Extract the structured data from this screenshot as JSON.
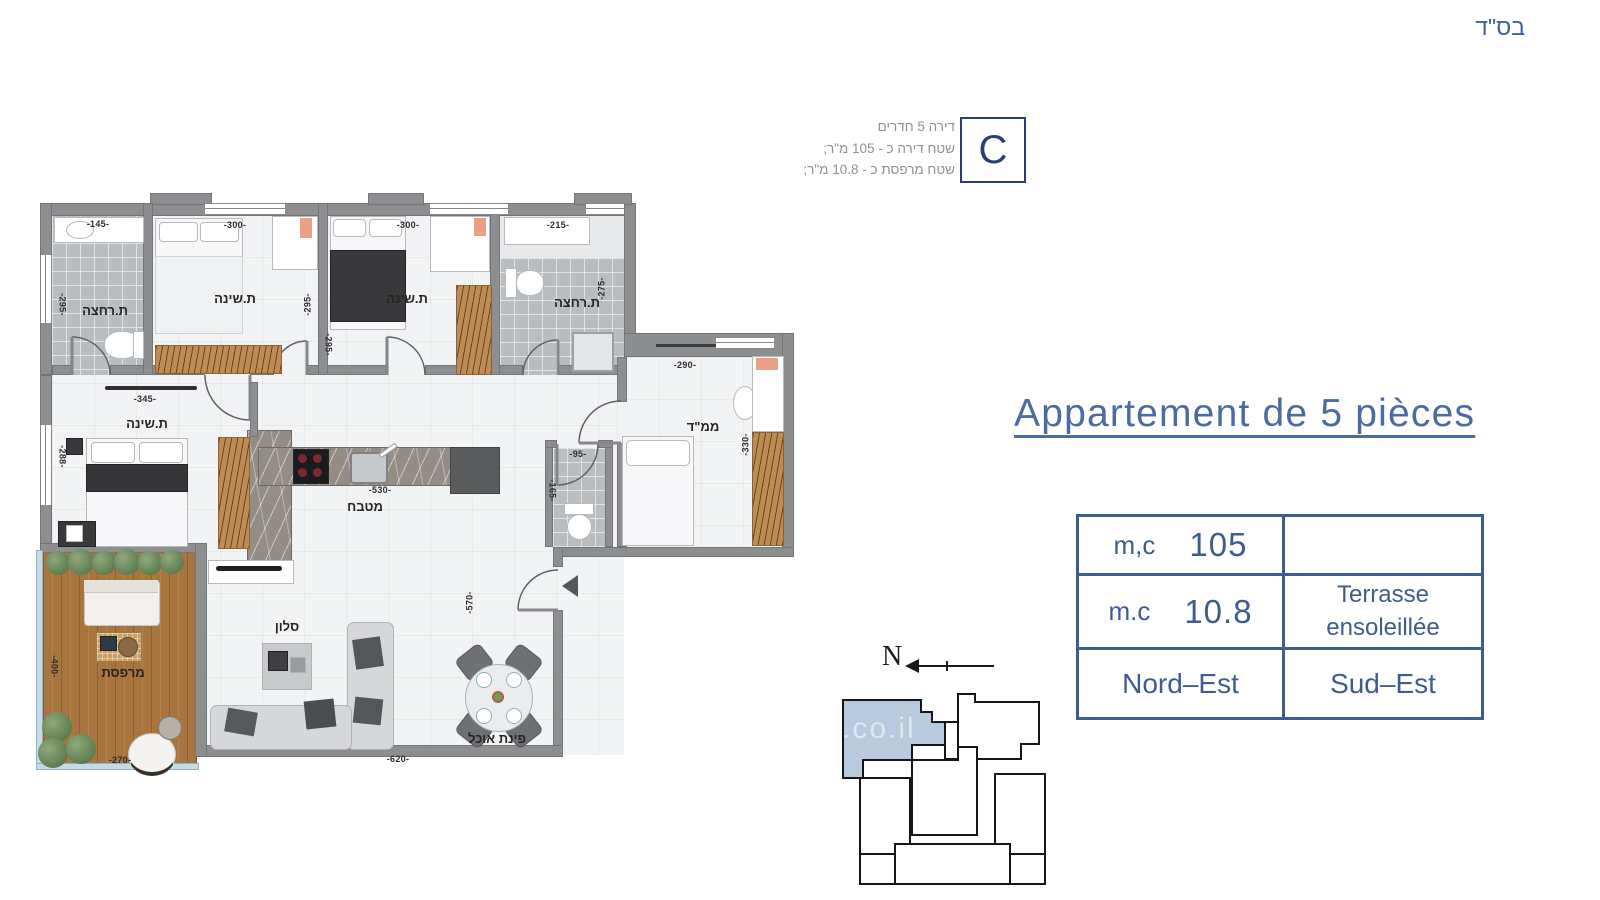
{
  "header": {
    "bsd": "בס\"ד"
  },
  "unit_info": {
    "line1": "דירה 5 חדרים",
    "line2": "שטח דירה כ - 105 מ\"ר;",
    "line3": "שטח מרפסת כ - 10.8 מ\"ר;",
    "unit_letter": "C"
  },
  "title": {
    "text": "Appartement de 5 pièces"
  },
  "spec_table": {
    "row1": {
      "label": "m,c",
      "value": "105",
      "right": ""
    },
    "row2": {
      "label": "m.c",
      "value": "10.8",
      "right_line1": "Terrasse",
      "right_line2": "ensoleillée"
    },
    "row3": {
      "left": "Nord–Est",
      "right": "Sud–Est"
    }
  },
  "compass": {
    "label": "N"
  },
  "keyplan": {
    "watermark": ".co.il"
  },
  "floorplan": {
    "rooms": {
      "bathroom1": "ת.רחצה",
      "bedroom1": "ת.שינה",
      "bedroom2": "ת.שינה",
      "bathroom2": "ת.רחצה",
      "master_bedroom": "ת.שינה",
      "safe_room": "ממ\"ד",
      "kitchen": "מטבח",
      "living_room": "סלון",
      "dining": "פינת אוכל",
      "balcony": "מרפסת"
    },
    "dims": {
      "bathroom1_w": "-145-",
      "bathroom1_h": "-295-",
      "bedroom1_w": "-300-",
      "bedroom1_h": "-295-",
      "bedroom2_w": "-300-",
      "bedroom2_h": "-295-",
      "bathroom2_w": "-215-",
      "bathroom2_h": "-275-",
      "master_w": "-345-",
      "master_h": "-288-",
      "safe_room_w": "-290-",
      "safe_room_h": "-330-",
      "wc_w": "-95-",
      "wc_h": "-165-",
      "kitchen_w": "-530-",
      "living_w": "-620-",
      "living_h": "-570-",
      "balcony_w": "-270-",
      "balcony_h": "-400-"
    }
  },
  "colors": {
    "accent_blue": "#3e5c8f",
    "title_blue": "#4c6ba3",
    "navy": "#2c3e78",
    "info_gray": "#8e9092",
    "unit_highlight": "#b7cade",
    "wall_gray": "#8d8e90",
    "wood": "#b5854f",
    "deck_wood": "#a9753f",
    "tile_gray": "#b9bdc0"
  }
}
